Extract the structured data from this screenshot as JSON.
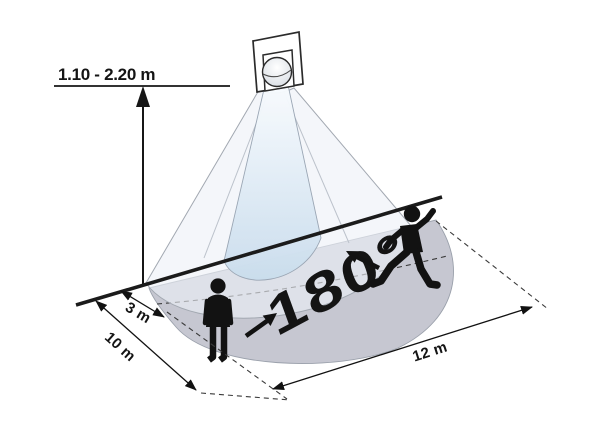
{
  "figure": {
    "type": "motion-sensor-range-diagram",
    "mount_height": {
      "label": "1.10 - 2.20 m"
    },
    "coverage_angle": {
      "label": "180°"
    },
    "dimensions": {
      "offset": {
        "label": "3 m"
      },
      "depth": {
        "label": "10 m"
      },
      "width": {
        "label": "12 m"
      }
    },
    "elements": [
      "wall-mounted-pir-sensor",
      "light-cone",
      "detection-beam",
      "semicircular-detection-area",
      "person-standing",
      "person-walking"
    ],
    "colors": {
      "background": "#ffffff",
      "ink": "#1a1a1a",
      "detection_area": "#c6c7d1",
      "cone": "#edf1f7",
      "beam_bottom": "#cadded"
    }
  }
}
